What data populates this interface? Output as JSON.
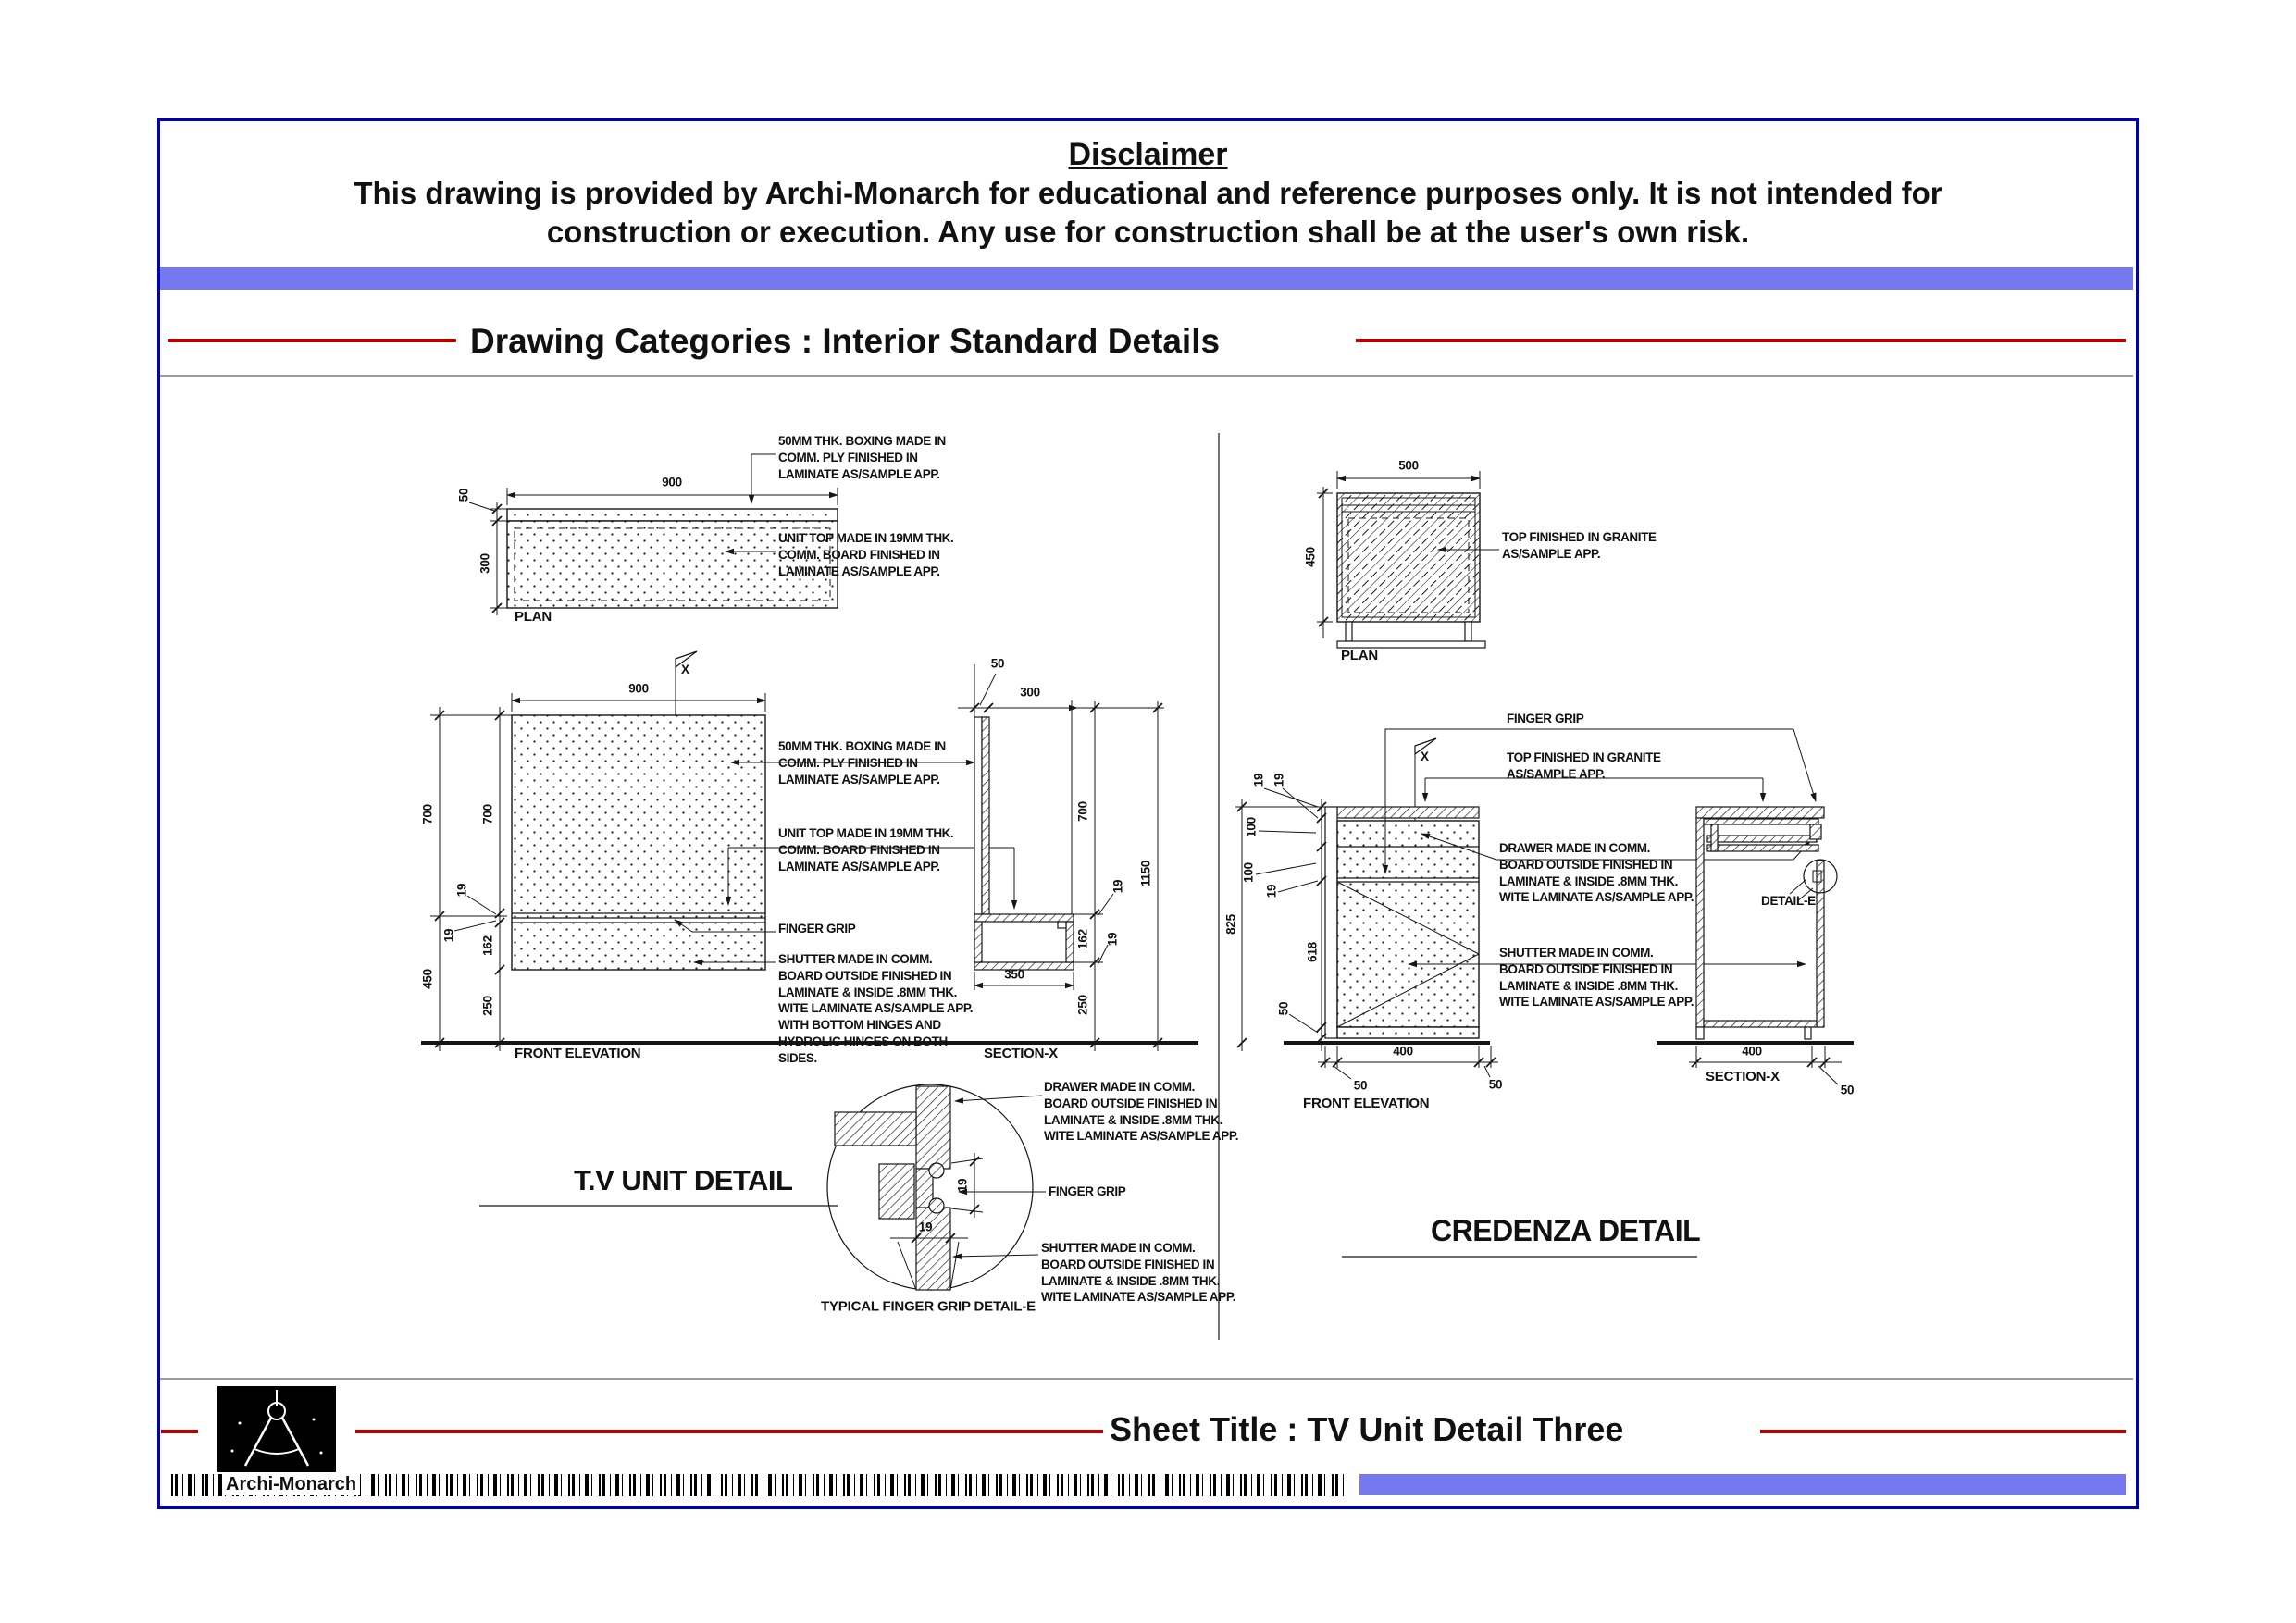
{
  "colors": {
    "border_blue": "#0000b5",
    "bar_blue": "#7678ef",
    "accent_red": "#c00000",
    "ink": "#161616",
    "gray_line": "#9a9a9a"
  },
  "disclaimer": {
    "title": "Disclaimer",
    "line1": "This drawing is provided by Archi-Monarch for educational and reference purposes only. It is not intended for",
    "line2": "construction or execution. Any use for construction shall be at the user's own risk."
  },
  "header": {
    "title": "Drawing Categories : Interior Standard Details"
  },
  "footer": {
    "sheet_title": "Sheet Title : TV Unit Detail Three",
    "brand": "Archi-Monarch"
  },
  "notes": {
    "boxing": "50MM THK. BOXING MADE IN COMM. PLY FINISHED IN LAMINATE AS/SAMPLE APP.",
    "unit_top": "UNIT TOP MADE IN 19MM THK. COMM. BOARD FINISHED IN LAMINATE AS/SAMPLE APP.",
    "finger_grip": "FINGER GRIP",
    "shutter_tv": "SHUTTER MADE IN COMM. BOARD OUTSIDE FINISHED IN LAMINATE & INSIDE .8MM THK. WITE LAMINATE AS/SAMPLE APP. WITH BOTTOM HINGES AND HYDROLIC HINGES ON BOTH SIDES.",
    "drawer": "DRAWER MADE IN COMM. BOARD OUTSIDE FINISHED IN LAMINATE & INSIDE .8MM THK. WITE LAMINATE AS/SAMPLE APP.",
    "shutter": "SHUTTER MADE IN COMM. BOARD OUTSIDE FINISHED IN LAMINATE & INSIDE .8MM THK. WITE LAMINATE AS/SAMPLE APP.",
    "granite": "TOP FINISHED IN GRANITE AS/SAMPLE APP."
  },
  "tv": {
    "title": "T.V UNIT DETAIL",
    "plan": {
      "caption": "PLAN",
      "w": "900",
      "thk": "50",
      "d": "300"
    },
    "elev": {
      "caption": "FRONT ELEVATION",
      "flag": "X",
      "w": "900",
      "h_top_outer": "700",
      "h_top_inner": "700",
      "t1": "19",
      "t2": "19",
      "shutter_h": "162",
      "h_bottom": "450",
      "plinth": "250"
    },
    "sec": {
      "caption": "SECTION-X",
      "thk": "50",
      "d": "300",
      "h_top": "700",
      "total": "1150",
      "t1": "19",
      "t2": "19",
      "box_h": "162",
      "box_w": "350",
      "plinth": "250"
    },
    "grip": {
      "caption": "TYPICAL FINGER GRIP DETAIL-E",
      "g1": "19",
      "g2": "19"
    }
  },
  "credenza": {
    "title": "CREDENZA  DETAIL",
    "plan": {
      "caption": "PLAN",
      "w": "500",
      "d": "450"
    },
    "elev": {
      "caption": "FRONT ELEVATION",
      "flag": "X",
      "t1": "19",
      "t2": "19",
      "d1": "100",
      "d2": "100",
      "t3": "19",
      "shutter_h": "618",
      "plinth": "50",
      "total": "825",
      "w": "400",
      "s1": "50",
      "s2": "50"
    },
    "sec": {
      "caption": "SECTION-X",
      "detail": "DETAIL-E",
      "w": "400",
      "s": "50"
    }
  }
}
